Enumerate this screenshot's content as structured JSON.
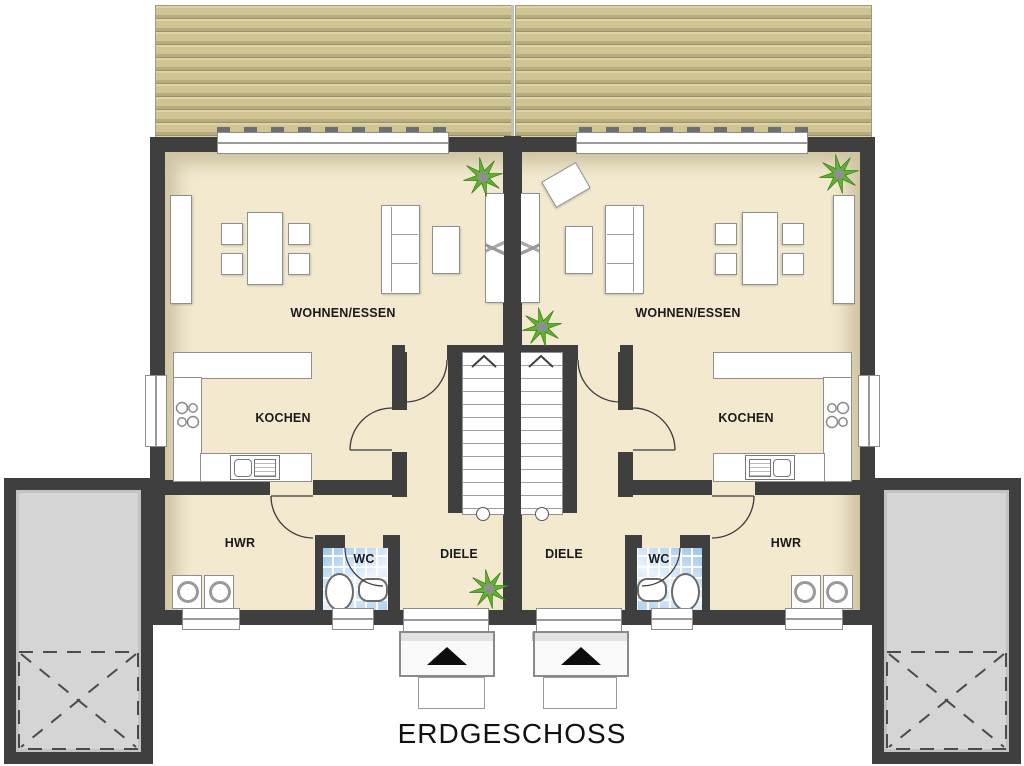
{
  "title": "ERDGESCHOSS",
  "units": {
    "left": {
      "living": "WOHNEN/ESSEN",
      "kitchen": "KOCHEN",
      "utility": "HWR",
      "wc": "WC",
      "hall": "DIELE"
    },
    "right": {
      "living": "WOHNEN/ESSEN",
      "kitchen": "KOCHEN",
      "utility": "HWR",
      "wc": "WC",
      "hall": "DIELE"
    }
  },
  "colors": {
    "wall": "#3f3f3f",
    "floor": "#f2e9cf",
    "terrace_wood": "#cfc492",
    "garage": "#d5d5d5",
    "wc_tile": "#aecfec",
    "plant_green": "#5fb32c",
    "label_text": "#1a1a1a"
  },
  "icons": {
    "plant": "plant-icon",
    "entrance_arrow": "entrance-arrow-icon",
    "stair_up_arrow": "stair-up-arrow-icon",
    "cooktop": "cooktop-icon",
    "garage_door_cross": "garage-door-cross-icon"
  }
}
